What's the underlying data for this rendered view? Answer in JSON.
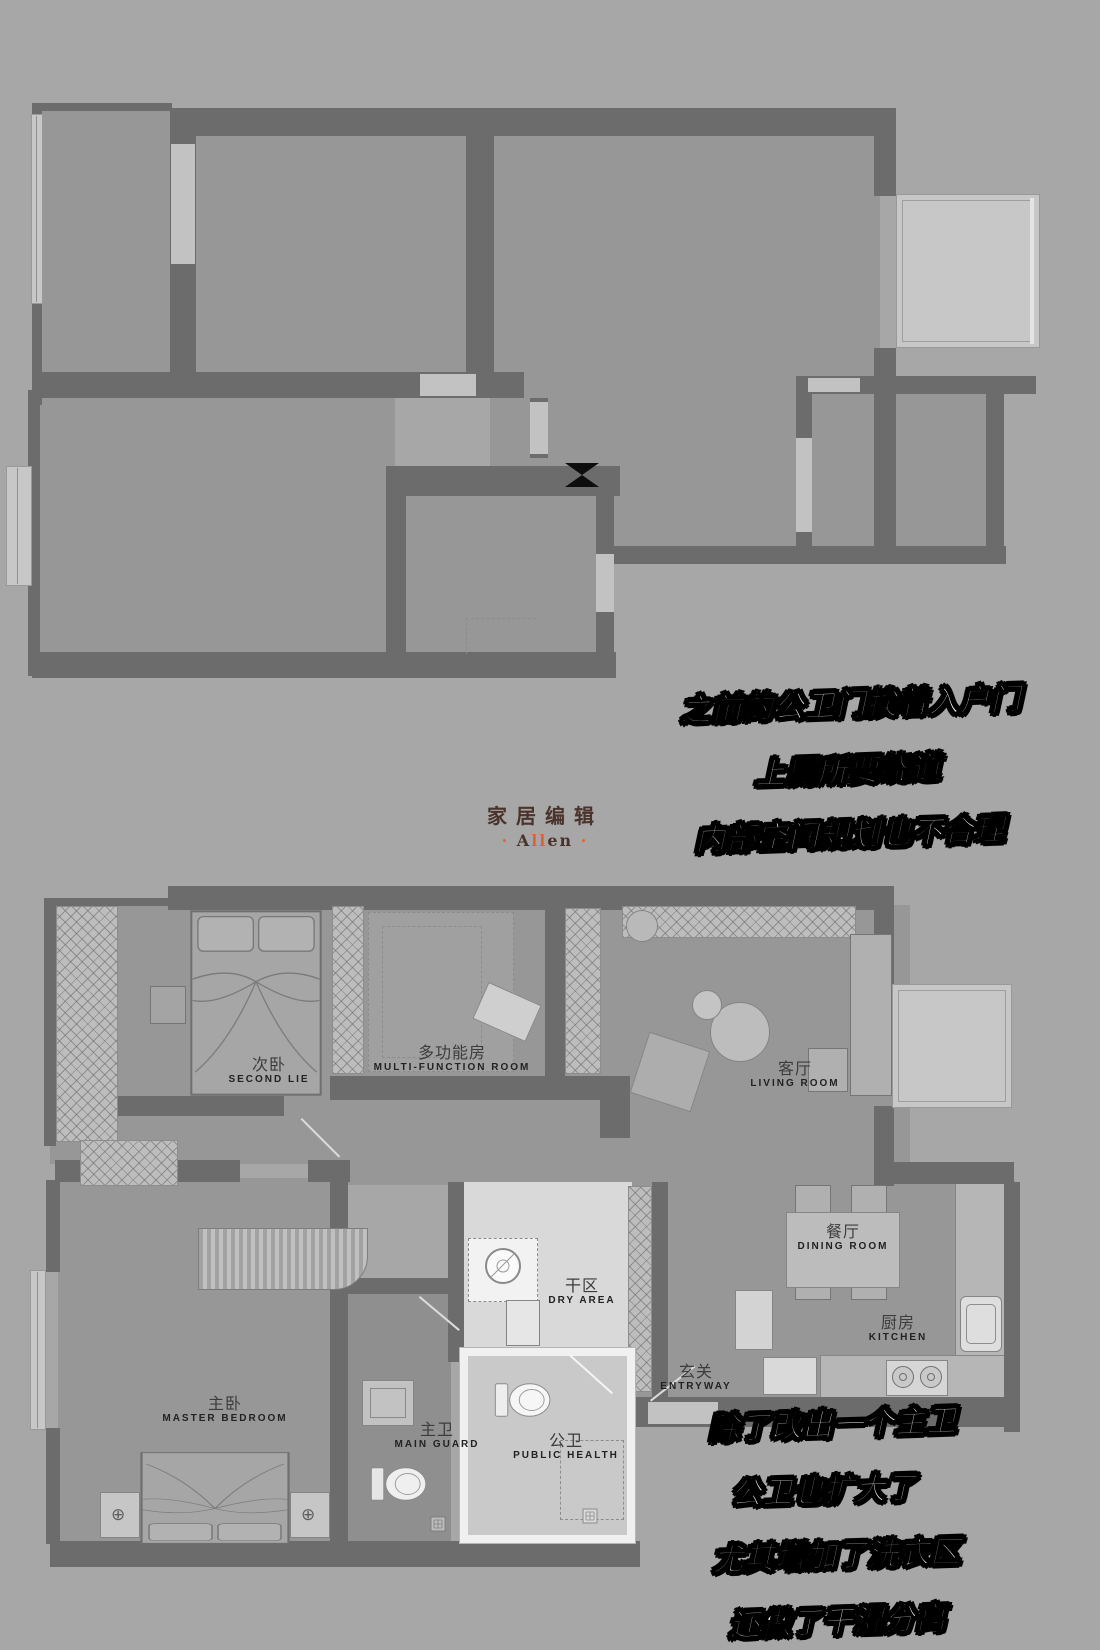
{
  "page": {
    "background": "#a7a7a7"
  },
  "colors": {
    "wall": "#6c6c6c",
    "floor": "#979797",
    "light_room": "#d9d9d9",
    "white_wall": "#f0f0f0",
    "window_bay": "#c7c7c7",
    "annotation_text": "#ffffff",
    "annotation_outline": "#000000",
    "logo_brown": "#4a332a",
    "logo_orange": "#e4632c",
    "label_text": "#222222"
  },
  "brand": {
    "zh": "家居编辑",
    "dot": "·",
    "name_a": "A",
    "name_ll": "ll",
    "name_en": "en"
  },
  "before_plan": {
    "notes": [
      "之前的公卫门挨着入户门",
      "上厕所要绕道",
      "内部空间规划也不合理"
    ]
  },
  "after_plan": {
    "notes": [
      "除了改出一个主卫",
      "公卫也扩大了",
      "尤其增加了洗衣区",
      "还做了干湿分离"
    ],
    "rooms": [
      {
        "id": "second-bedroom",
        "zh": "次卧",
        "en": "SECOND LIE"
      },
      {
        "id": "multi-function-room",
        "zh": "多功能房",
        "en": "MULTI-FUNCTION ROOM"
      },
      {
        "id": "living-room",
        "zh": "客厅",
        "en": "LIVING ROOM"
      },
      {
        "id": "dining-room",
        "zh": "餐厅",
        "en": "DINING ROOM"
      },
      {
        "id": "kitchen",
        "zh": "厨房",
        "en": "KITCHEN"
      },
      {
        "id": "entryway",
        "zh": "玄关",
        "en": "ENTRYWAY"
      },
      {
        "id": "dry-area",
        "zh": "干区",
        "en": "DRY AREA"
      },
      {
        "id": "master-bedroom",
        "zh": "主卧",
        "en": "MASTER BEDROOM"
      },
      {
        "id": "master-bathroom",
        "zh": "主卫",
        "en": "MAIN GUARD"
      },
      {
        "id": "public-bathroom",
        "zh": "公卫",
        "en": "PUBLIC HEALTH"
      }
    ]
  }
}
